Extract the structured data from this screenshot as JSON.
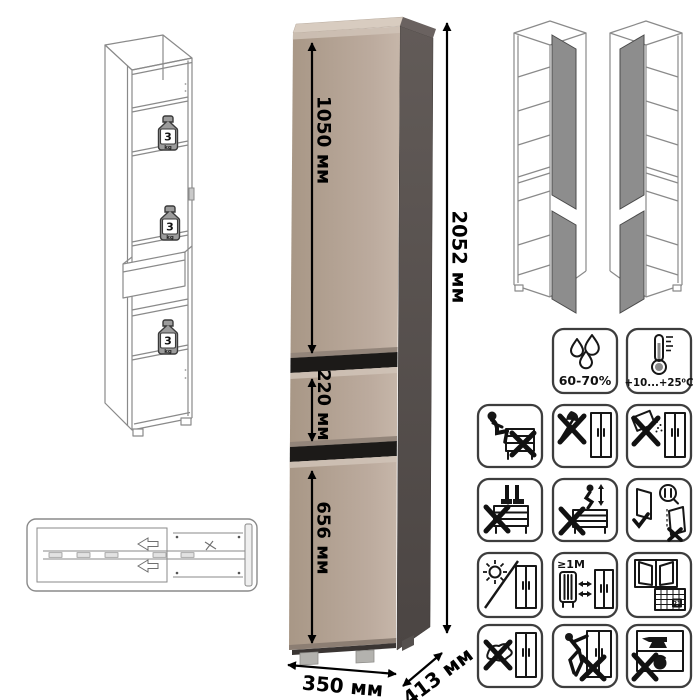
{
  "cabinet": {
    "dimensions": {
      "total_height": "2052 мм",
      "upper_door": "1050 мм",
      "drawer": "220 мм",
      "lower_door": "656 мм",
      "width": "350 мм",
      "depth": "413 мм"
    },
    "max_shelf_load": {
      "value": "3",
      "unit": "kg"
    },
    "colors": {
      "front": "#b2a093",
      "front_highlight": "#d0c3b7",
      "side": "#564f4d",
      "top": "#d8ccc0",
      "gap": "#1c1a18",
      "feet": "#b3b2ae",
      "wireframe": "#8a8a8a",
      "door_panel_gray": "#8d8d8d"
    }
  },
  "conditions": {
    "humidity": "60-70%",
    "temperature": "+10...+25⁰C"
  },
  "care": {
    "distance": "≥1M",
    "calendar_day": "21",
    "icons": [
      "no-sitting",
      "no-sharp-tools",
      "no-abrasives",
      "no-standing",
      "no-jumping",
      "door-adjustment",
      "no-direct-sunlight",
      "heat-source-distance",
      "ventilate-room",
      "no-wet-cleaning",
      "no-dragging",
      "no-heavy-load"
    ]
  }
}
